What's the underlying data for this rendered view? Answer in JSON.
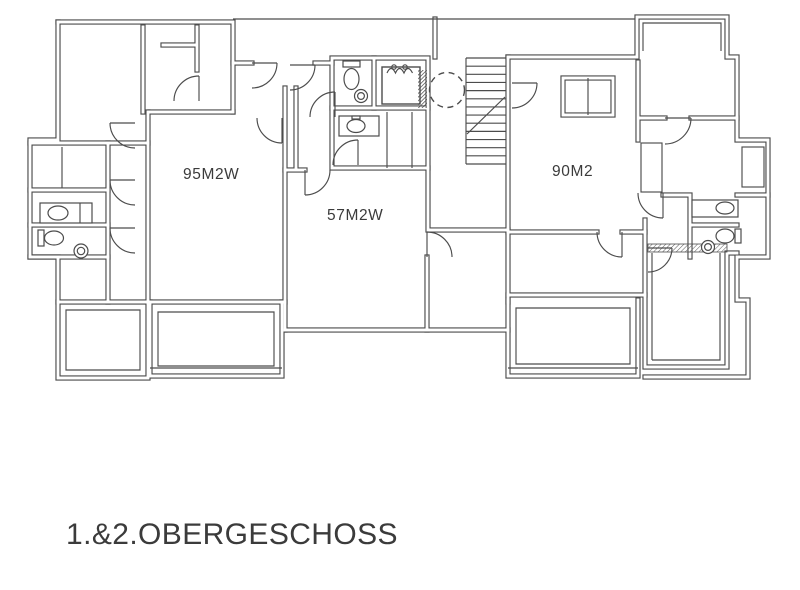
{
  "palette": {
    "line": "#4c4c4c",
    "ink": "#3b3b3b",
    "paper": "#ffffff"
  },
  "floor_plan": {
    "caption": "1.&2.OBERGESCHOSS",
    "apartments": [
      {
        "id": "apartment-left",
        "label": "95M2W"
      },
      {
        "id": "apartment-middle",
        "label": "57M2W"
      },
      {
        "id": "apartment-right",
        "label": "90M2"
      }
    ],
    "staircase": {
      "treads": 14
    },
    "icon_names": [
      "staircase-icon",
      "elevator-shaft-icon",
      "dashed-circle-marker",
      "door-swing-icon",
      "toilet-icon",
      "sink-icon",
      "balcony-railing"
    ]
  }
}
